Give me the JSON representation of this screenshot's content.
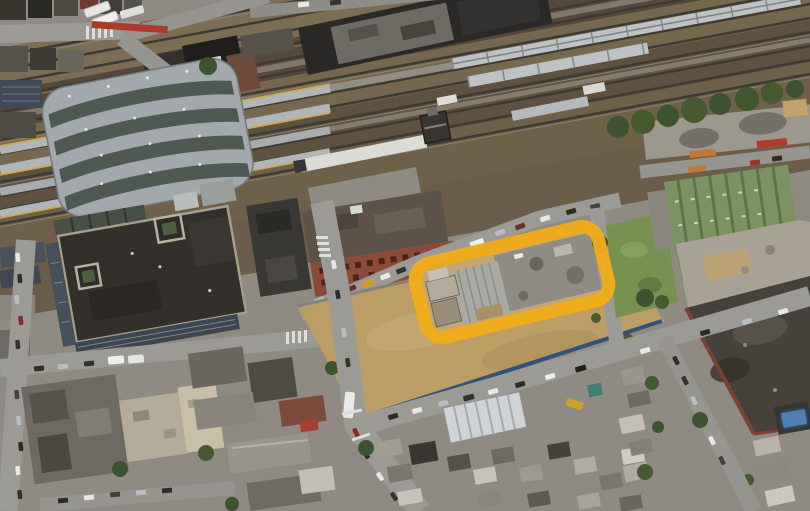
{
  "map_view": {
    "type": "oblique-aerial-photo",
    "scene": "rail-yard-station-and-industrial-parcel",
    "highlight_overlay": {
      "shape": "rounded-rectangle-outline",
      "x": 418,
      "y": 244,
      "width": 188,
      "height": 76,
      "corner_radius": 17,
      "rotation": "rotate(-13.5 512 282)",
      "stroke_color": "#F0AD18",
      "stroke_width": 13
    },
    "palette": {
      "ballast": "#6b5d49",
      "dirt": "#bb9d66",
      "grass": "#779150",
      "canopy": "#a3a8ac",
      "office_roof": "#332f2b",
      "school_roof": "#46413a",
      "green_roof": "#7b9362",
      "pool": "#4f7fb5",
      "fence_blue": "#31517c",
      "road": "#9b9a95",
      "train": "#bfc2c5",
      "platform": "#b2b5b6",
      "brick": "#8c4b38"
    }
  }
}
